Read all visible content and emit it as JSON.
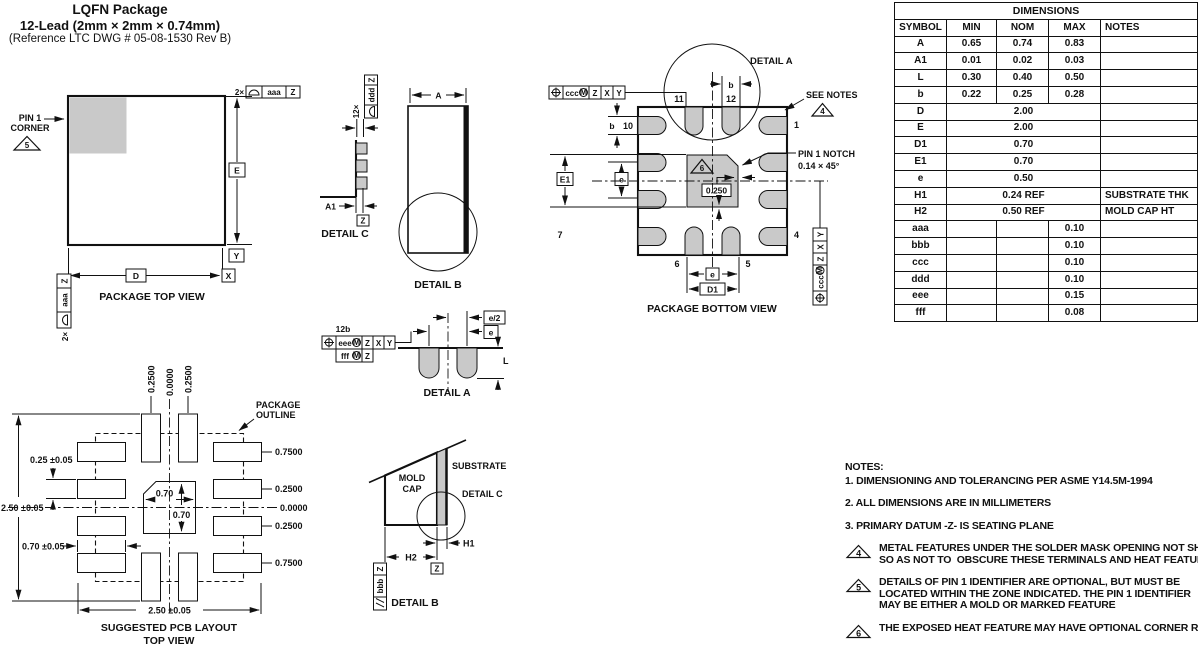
{
  "title": {
    "line1": "LQFN Package",
    "line2": "12-Lead (2mm × 2mm × 0.74mm)",
    "line3": "(Reference LTC DWG # 05-08-1530 Rev B)"
  },
  "dimensions_table": {
    "title": "DIMENSIONS",
    "headers": [
      "SYMBOL",
      "MIN",
      "NOM",
      "MAX",
      "NOTES"
    ],
    "rows": [
      {
        "symbol": "A",
        "min": "0.65",
        "nom": "0.74",
        "max": "0.83",
        "notes": ""
      },
      {
        "symbol": "A1",
        "min": "0.01",
        "nom": "0.02",
        "max": "0.03",
        "notes": ""
      },
      {
        "symbol": "L",
        "min": "0.30",
        "nom": "0.40",
        "max": "0.50",
        "notes": ""
      },
      {
        "symbol": "b",
        "min": "0.22",
        "nom": "0.25",
        "max": "0.28",
        "notes": ""
      },
      {
        "symbol": "D",
        "span": "2.00",
        "notes": ""
      },
      {
        "symbol": "E",
        "span": "2.00",
        "notes": ""
      },
      {
        "symbol": "D1",
        "span": "0.70",
        "notes": ""
      },
      {
        "symbol": "E1",
        "span": "0.70",
        "notes": ""
      },
      {
        "symbol": "e",
        "span": "0.50",
        "notes": ""
      },
      {
        "symbol": "H1",
        "span": "0.24 REF",
        "notes": "SUBSTRATE THK"
      },
      {
        "symbol": "H2",
        "span": "0.50 REF",
        "notes": "MOLD CAP HT"
      },
      {
        "symbol": "aaa",
        "min": "",
        "nom": "",
        "max": "0.10",
        "notes": ""
      },
      {
        "symbol": "bbb",
        "min": "",
        "nom": "",
        "max": "0.10",
        "notes": ""
      },
      {
        "symbol": "ccc",
        "min": "",
        "nom": "",
        "max": "0.10",
        "notes": ""
      },
      {
        "symbol": "ddd",
        "min": "",
        "nom": "",
        "max": "0.10",
        "notes": ""
      },
      {
        "symbol": "eee",
        "min": "",
        "nom": "",
        "max": "0.15",
        "notes": ""
      },
      {
        "symbol": "fff",
        "min": "",
        "nom": "",
        "max": "0.08",
        "notes": ""
      }
    ]
  },
  "notes": {
    "heading": "NOTES:",
    "items": [
      {
        "flag": null,
        "lines": [
          "1. DIMENSIONING AND TOLERANCING PER ASME Y14.5M-1994"
        ]
      },
      {
        "flag": null,
        "lines": [
          "2. ALL DIMENSIONS ARE IN MILLIMETERS"
        ]
      },
      {
        "flag": null,
        "lines": [
          "3. PRIMARY DATUM -Z- IS SEATING PLANE"
        ]
      },
      {
        "flag": "4",
        "lines": [
          "METAL FEATURES UNDER THE SOLDER MASK OPENING NOT SHOWN",
          "SO AS NOT TO  OBSCURE THESE TERMINALS AND HEAT FEATURES"
        ]
      },
      {
        "flag": "5",
        "lines": [
          "DETAILS OF PIN 1 IDENTIFIER ARE OPTIONAL, BUT MUST BE",
          "LOCATED WITHIN THE ZONE INDICATED. THE PIN 1 IDENTIFIER",
          "MAY BE EITHER A MOLD OR MARKED FEATURE"
        ]
      },
      {
        "flag": "6",
        "lines": [
          "THE EXPOSED HEAT FEATURE MAY HAVE OPTIONAL CORNER RADII"
        ]
      }
    ]
  },
  "symbols": {
    "m": "M"
  },
  "drawings": {
    "top_view": {
      "caption": "PACKAGE TOP VIEW",
      "pin1_line1": "PIN 1",
      "pin1_line2": "CORNER",
      "flag": "5",
      "qty": "2×",
      "tol_aaa": "aaa",
      "datum_z": "Z",
      "dim_e": "E",
      "dim_d": "D",
      "datum_x": "X",
      "datum_y": "Y"
    },
    "detail_c": {
      "caption": "DETAIL C",
      "qty": "12×",
      "tol_ddd": "ddd",
      "datum_z": "Z",
      "dim_a1": "A1"
    },
    "detail_b": {
      "caption": "DETAIL B",
      "dim_a": "A"
    },
    "bottom_view": {
      "caption": "PACKAGE BOTTOM VIEW",
      "detail_a_label": "DETAIL A",
      "see_notes": "SEE NOTES",
      "flag_notes": "4",
      "notch_line1": "PIN 1 NOTCH",
      "notch_line2": "0.14 × 45°",
      "flag_heat": "6",
      "dim_center": "0.250",
      "dim_b": "b",
      "dim_e1": "E1",
      "dim_e": "e",
      "dim_d1": "D1",
      "tol_ccc": "ccc",
      "datum_z": "Z",
      "datum_x": "X",
      "datum_y": "Y",
      "pin_1": "1",
      "pin_4": "4",
      "pin_5": "5",
      "pin_6": "6",
      "pin_7": "7",
      "pin_10": "10",
      "pin_11": "11",
      "pin_12": "12"
    },
    "detail_a": {
      "caption": "DETAIL A",
      "qty": "12b",
      "tol_eee": "eee",
      "tol_fff": "fff",
      "datum_z": "Z",
      "datum_x": "X",
      "datum_y": "Y",
      "dim_e_half": "e/2",
      "dim_e": "e",
      "dim_l": "L"
    },
    "pcb": {
      "caption_line1": "SUGGESTED PCB LAYOUT",
      "caption_line2": "TOP VIEW",
      "outline_line1": "PACKAGE",
      "outline_line2": "OUTLINE",
      "col_labels": [
        "0.2500",
        "0.0000",
        "0.2500"
      ],
      "row_labels": [
        "0.7500",
        "0.2500",
        "0.0000",
        "0.2500",
        "0.7500"
      ],
      "dim_height": "2.50 ±0.05",
      "dim_pad_width": "0.25 ±0.05",
      "dim_pad_length": "0.70 ±0.05",
      "dim_width": "2.50 ±0.05",
      "dim_center_w": "0.70",
      "dim_center_h": "0.70"
    },
    "detail_b_section": {
      "caption": "DETAIL B",
      "mold_line1": "MOLD",
      "mold_line2": "CAP",
      "substrate": "SUBSTRATE",
      "detail_c_ref": "DETAIL C",
      "dim_h1": "H1",
      "dim_h2": "H2",
      "tol_bbb": "bbb",
      "datum_z": "Z"
    }
  }
}
